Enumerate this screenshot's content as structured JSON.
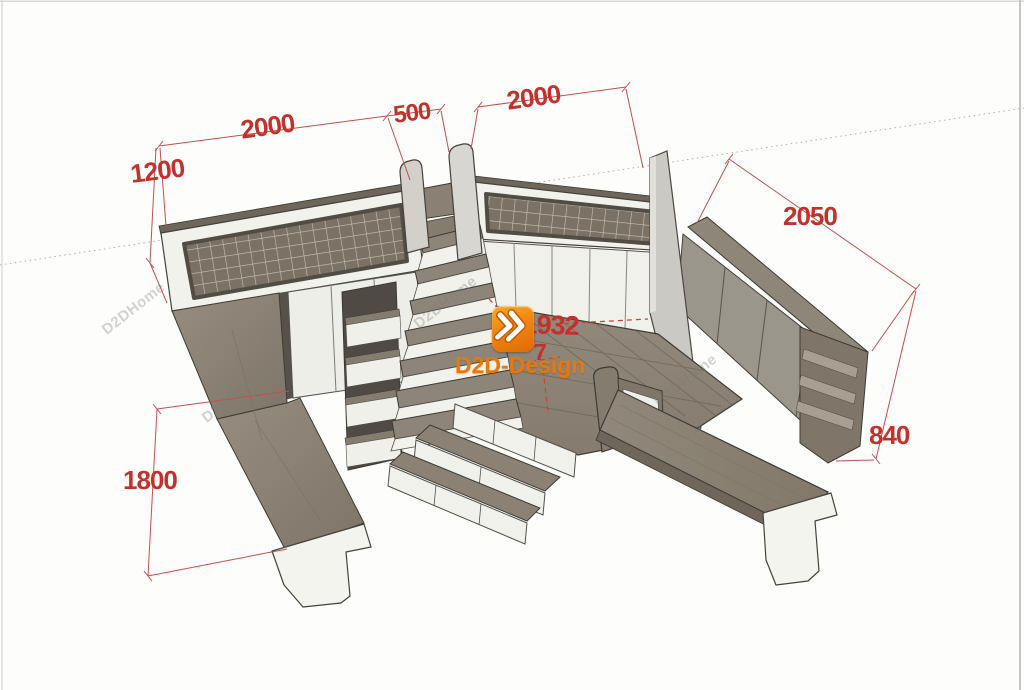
{
  "scene": {
    "description": "3D loft-bed room design render with dimension annotations",
    "background": "#fdfdfb"
  },
  "dims": {
    "left_bed_length": "2000",
    "stair_gap_width": "500",
    "right_bed_length": "2000",
    "guard_rail_height": "1200",
    "side_cabinet_length": "2050",
    "side_cabinet_height": "840",
    "left_desk_length": "1800",
    "platform_diagonal": "1932",
    "occluded_dimension": "7"
  },
  "logo": {
    "brand_name": "D2D-Design"
  },
  "watermark": {
    "text": "D2DHome"
  },
  "colors": {
    "dimension_red": "#c3312c",
    "logo_orange": "#ec7d0e",
    "wood": "#8b8275",
    "panel_white": "#f2f2ec"
  }
}
